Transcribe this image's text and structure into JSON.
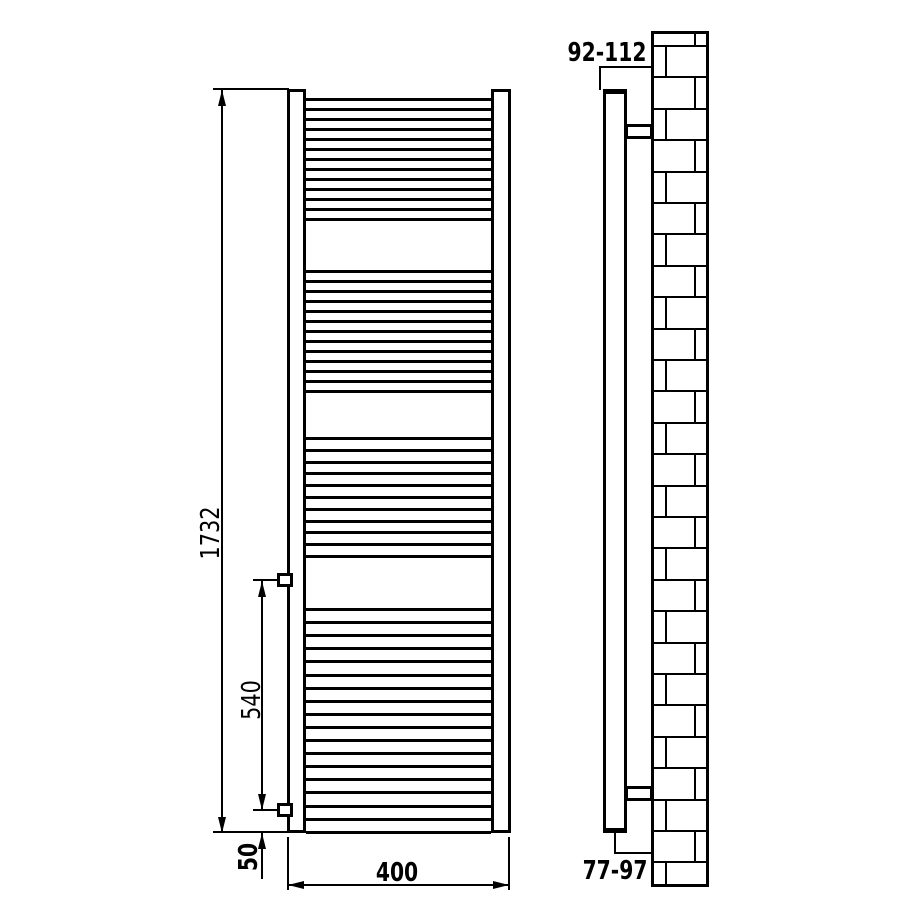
{
  "front_view": {
    "labels": {
      "overall_height": "1732",
      "bracket_spacing": "540",
      "bracket_bottom_offset": "50",
      "overall_width": "400"
    },
    "rung_bands": [
      {
        "start": 98,
        "pitch": 10,
        "count": 13
      },
      {
        "start": 270,
        "pitch": 10,
        "count": 13
      },
      {
        "start": 437,
        "pitch": 11.8,
        "count": 11
      },
      {
        "start": 608,
        "pitch": 13.1,
        "count": 18
      }
    ]
  },
  "side_view": {
    "labels": {
      "wall_clearance_top": "92-112",
      "wall_clearance_bottom": "77-97"
    },
    "wall": {
      "top": 31,
      "bottom": 887,
      "left": 651,
      "right": 709,
      "first_course_y": 45,
      "course_height": 31.4,
      "joint_x_left": 665,
      "joint_x_right": 694
    }
  },
  "colors": {
    "line": "#000000",
    "background": "#ffffff"
  }
}
